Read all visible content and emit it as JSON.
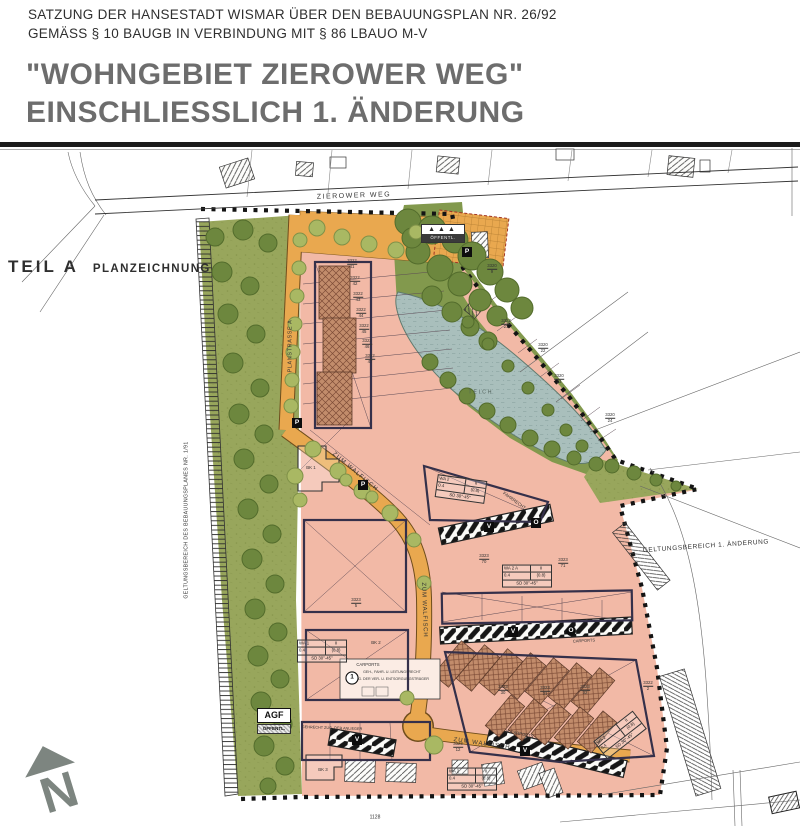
{
  "header": {
    "line1": "SATZUNG DER HANSESTADT WISMAR ÜBER DEN BEBAUUNGSPLAN NR. 26/92",
    "line2": "GEMÄSS § 10 BAUGB IN VERBINDUNG MIT § 86 LBAUO M-V",
    "title1": "\"WOHNGEBIET ZIEROWER WEG\"",
    "title2": "EINSCHLIESSLICH  1. ÄNDERUNG"
  },
  "part_label": {
    "teil": "TEIL A",
    "name": "PLANZEICHNUNG"
  },
  "north": {
    "letter": "N"
  },
  "agf": {
    "label": "AGF",
    "sub": "ÖFFENTL."
  },
  "tree_box": {
    "symbols": "▲▲▲",
    "label": "ÖFFENTL."
  },
  "colors": {
    "residential_pink": "#f2b9a6",
    "meadow_green": "#98a65c",
    "tree_green": "#6d873e",
    "water_blue": "#a9bfbc",
    "road_orange": "#e9a84f",
    "boundary_black": "#141414",
    "title_gray": "#6d6d6d",
    "building_hatch_brown": "#c28c6b"
  },
  "plan": {
    "labels": [
      {
        "t": "ZIEROWER WEG",
        "x": 354,
        "y": 196,
        "r": -2,
        "s": 7,
        "ls": 1.5,
        "n": "street-label-zierower-weg"
      },
      {
        "t": "PLANSTRASSE A",
        "x": 291,
        "y": 346,
        "r": -90,
        "s": 5.5,
        "ls": 0.6,
        "n": "street-label-planstrasse-a"
      },
      {
        "t": "ZUM WALFISCH",
        "x": 355,
        "y": 472,
        "r": 40,
        "s": 6,
        "ls": 1,
        "n": "street-label-zum-walfisch-1"
      },
      {
        "t": "ZUM WALFISCH",
        "x": 424,
        "y": 610,
        "r": 88,
        "s": 6,
        "ls": 0.8,
        "n": "street-label-zum-walfisch-2"
      },
      {
        "t": "ZUM WALFISCH",
        "x": 482,
        "y": 744,
        "r": 8,
        "s": 6,
        "ls": 1,
        "n": "street-label-zum-walfisch-3"
      },
      {
        "t": "TEICH",
        "x": 481,
        "y": 393,
        "r": 0,
        "s": 5,
        "ls": 2,
        "c": "#4e5e57",
        "n": "pond-label"
      },
      {
        "t": "GELTUNGSBEREICH DES BEBAUUNGSPLANES NR. 1/91",
        "x": 187,
        "y": 520,
        "r": -90,
        "s": 5.2,
        "ls": 0.4,
        "n": "label-geltungsbereich-bplan"
      },
      {
        "t": "GELTUNGSBEREICH 1. ÄNDERUNG",
        "x": 706,
        "y": 547,
        "r": -4,
        "s": 6.5,
        "ls": 0.6,
        "n": "label-geltungsbereich-aenderung"
      },
      {
        "t": "CARPORTS",
        "x": 368,
        "y": 665,
        "r": 0,
        "s": 4.2,
        "n": "label-carports-1"
      },
      {
        "t": "12 CARPORTS",
        "x": 519,
        "y": 734,
        "r": 11,
        "s": 4.2,
        "n": "label-carports-2"
      },
      {
        "t": "CARPORTS",
        "x": 584,
        "y": 641,
        "r": -3,
        "s": 4,
        "n": "label-carports-3"
      },
      {
        "t": "FAHRRECHT",
        "x": 514,
        "y": 501,
        "r": 36,
        "s": 4.4,
        "n": "label-fahrrecht"
      },
      {
        "t": "GEHRECHT ZUG. DER ANLIEGER",
        "x": 332,
        "y": 729,
        "r": 2,
        "s": 3.8,
        "n": "label-gehrecht"
      },
      {
        "t": "GEH-, FAHR- U. LEITUNGSRECHT",
        "x": 392,
        "y": 673,
        "r": 0,
        "s": 3.6,
        "n": "label-leitungsrecht-1"
      },
      {
        "t": "Z.G. DER VER- U. ENTSORGUNGSTRÄGER",
        "x": 392,
        "y": 680,
        "r": 0,
        "s": 3.6,
        "n": "label-leitungsrecht-2"
      },
      {
        "t": "BK 1",
        "x": 311,
        "y": 468,
        "r": 0,
        "s": 4.4,
        "n": "label-bk1"
      },
      {
        "t": "BK 2",
        "x": 376,
        "y": 643,
        "r": 0,
        "s": 4.4,
        "n": "label-bk2"
      },
      {
        "t": "BK 3",
        "x": 323,
        "y": 770,
        "r": 0,
        "s": 4.4,
        "n": "label-bk3"
      },
      {
        "t": "1128",
        "x": 375,
        "y": 818,
        "r": 0,
        "s": 5,
        "n": "label-parcel-1128"
      }
    ],
    "markers": [
      {
        "t": "P",
        "x": 297,
        "y": 423,
        "k": "box"
      },
      {
        "t": "P",
        "x": 363,
        "y": 485,
        "k": "box"
      },
      {
        "t": "P",
        "x": 467,
        "y": 252,
        "k": "box"
      },
      {
        "t": "V",
        "x": 489,
        "y": 527,
        "k": "box"
      },
      {
        "t": "O",
        "x": 536,
        "y": 523,
        "k": "box"
      },
      {
        "t": "V",
        "x": 513,
        "y": 632,
        "k": "box"
      },
      {
        "t": "O",
        "x": 571,
        "y": 631,
        "k": "circle"
      },
      {
        "t": "V",
        "x": 357,
        "y": 740,
        "k": "box"
      },
      {
        "t": "V",
        "x": 525,
        "y": 751,
        "k": "box"
      },
      {
        "t": "1",
        "x": 352,
        "y": 678,
        "k": "ring"
      }
    ],
    "wa_tables": [
      {
        "x": 461,
        "y": 489,
        "r": 8,
        "rows": [
          [
            "WA 2",
            "II"
          ],
          [
            "0.4",
            "(0.8)"
          ],
          [
            "SD 30°-45°"
          ]
        ]
      },
      {
        "x": 527,
        "y": 576,
        "r": 0,
        "rows": [
          [
            "WA 2 A",
            "II"
          ],
          [
            "0.4",
            "(0.8)"
          ],
          [
            "SD 30°-45°"
          ]
        ]
      },
      {
        "x": 322,
        "y": 651,
        "r": 0,
        "rows": [
          [
            "WA 1",
            "II"
          ],
          [
            "0.4",
            "(0.8)"
          ],
          [
            "SD 30°-45°"
          ]
        ]
      },
      {
        "x": 472,
        "y": 779,
        "r": 0,
        "rows": [
          [
            "WA 2",
            "II"
          ],
          [
            "0.4",
            "(0.8)"
          ],
          [
            "SD 30°-45°"
          ]
        ]
      },
      {
        "x": 620,
        "y": 735,
        "r": -38,
        "rows": [
          [
            "WA 2",
            "II"
          ],
          [
            "0.4",
            "(0.8)"
          ],
          [
            "SD 30°-45°"
          ]
        ]
      }
    ],
    "parcels": [
      {
        "x": 352,
        "y": 264,
        "a": "3322",
        "b": "41"
      },
      {
        "x": 355,
        "y": 281,
        "a": "3322",
        "b": "42"
      },
      {
        "x": 358,
        "y": 297,
        "a": "3322",
        "b": "43"
      },
      {
        "x": 361,
        "y": 313,
        "a": "3322",
        "b": "44"
      },
      {
        "x": 364,
        "y": 329,
        "a": "3322",
        "b": "45"
      },
      {
        "x": 367,
        "y": 344,
        "a": "3322",
        "b": "46"
      },
      {
        "x": 370,
        "y": 359,
        "a": "3322",
        "b": "47"
      },
      {
        "x": 492,
        "y": 269,
        "a": "3320",
        "b": "9"
      },
      {
        "x": 506,
        "y": 324,
        "a": "3322",
        "b": "21"
      },
      {
        "x": 543,
        "y": 348,
        "a": "3320",
        "b": "22"
      },
      {
        "x": 559,
        "y": 379,
        "a": "3320",
        "b": "23"
      },
      {
        "x": 610,
        "y": 418,
        "a": "3320",
        "b": "24"
      },
      {
        "x": 484,
        "y": 559,
        "a": "3323",
        "b": "70"
      },
      {
        "x": 563,
        "y": 563,
        "a": "3323",
        "b": "71"
      },
      {
        "x": 356,
        "y": 603,
        "a": "3323",
        "b": "5"
      },
      {
        "x": 503,
        "y": 690,
        "a": "3323",
        "b": "30"
      },
      {
        "x": 545,
        "y": 691,
        "a": "3323",
        "b": "31"
      },
      {
        "x": 585,
        "y": 690,
        "a": "3323",
        "b": "32"
      },
      {
        "x": 458,
        "y": 747,
        "a": "3323",
        "b": "12"
      },
      {
        "x": 648,
        "y": 686,
        "a": "3322",
        "b": "2"
      }
    ]
  }
}
